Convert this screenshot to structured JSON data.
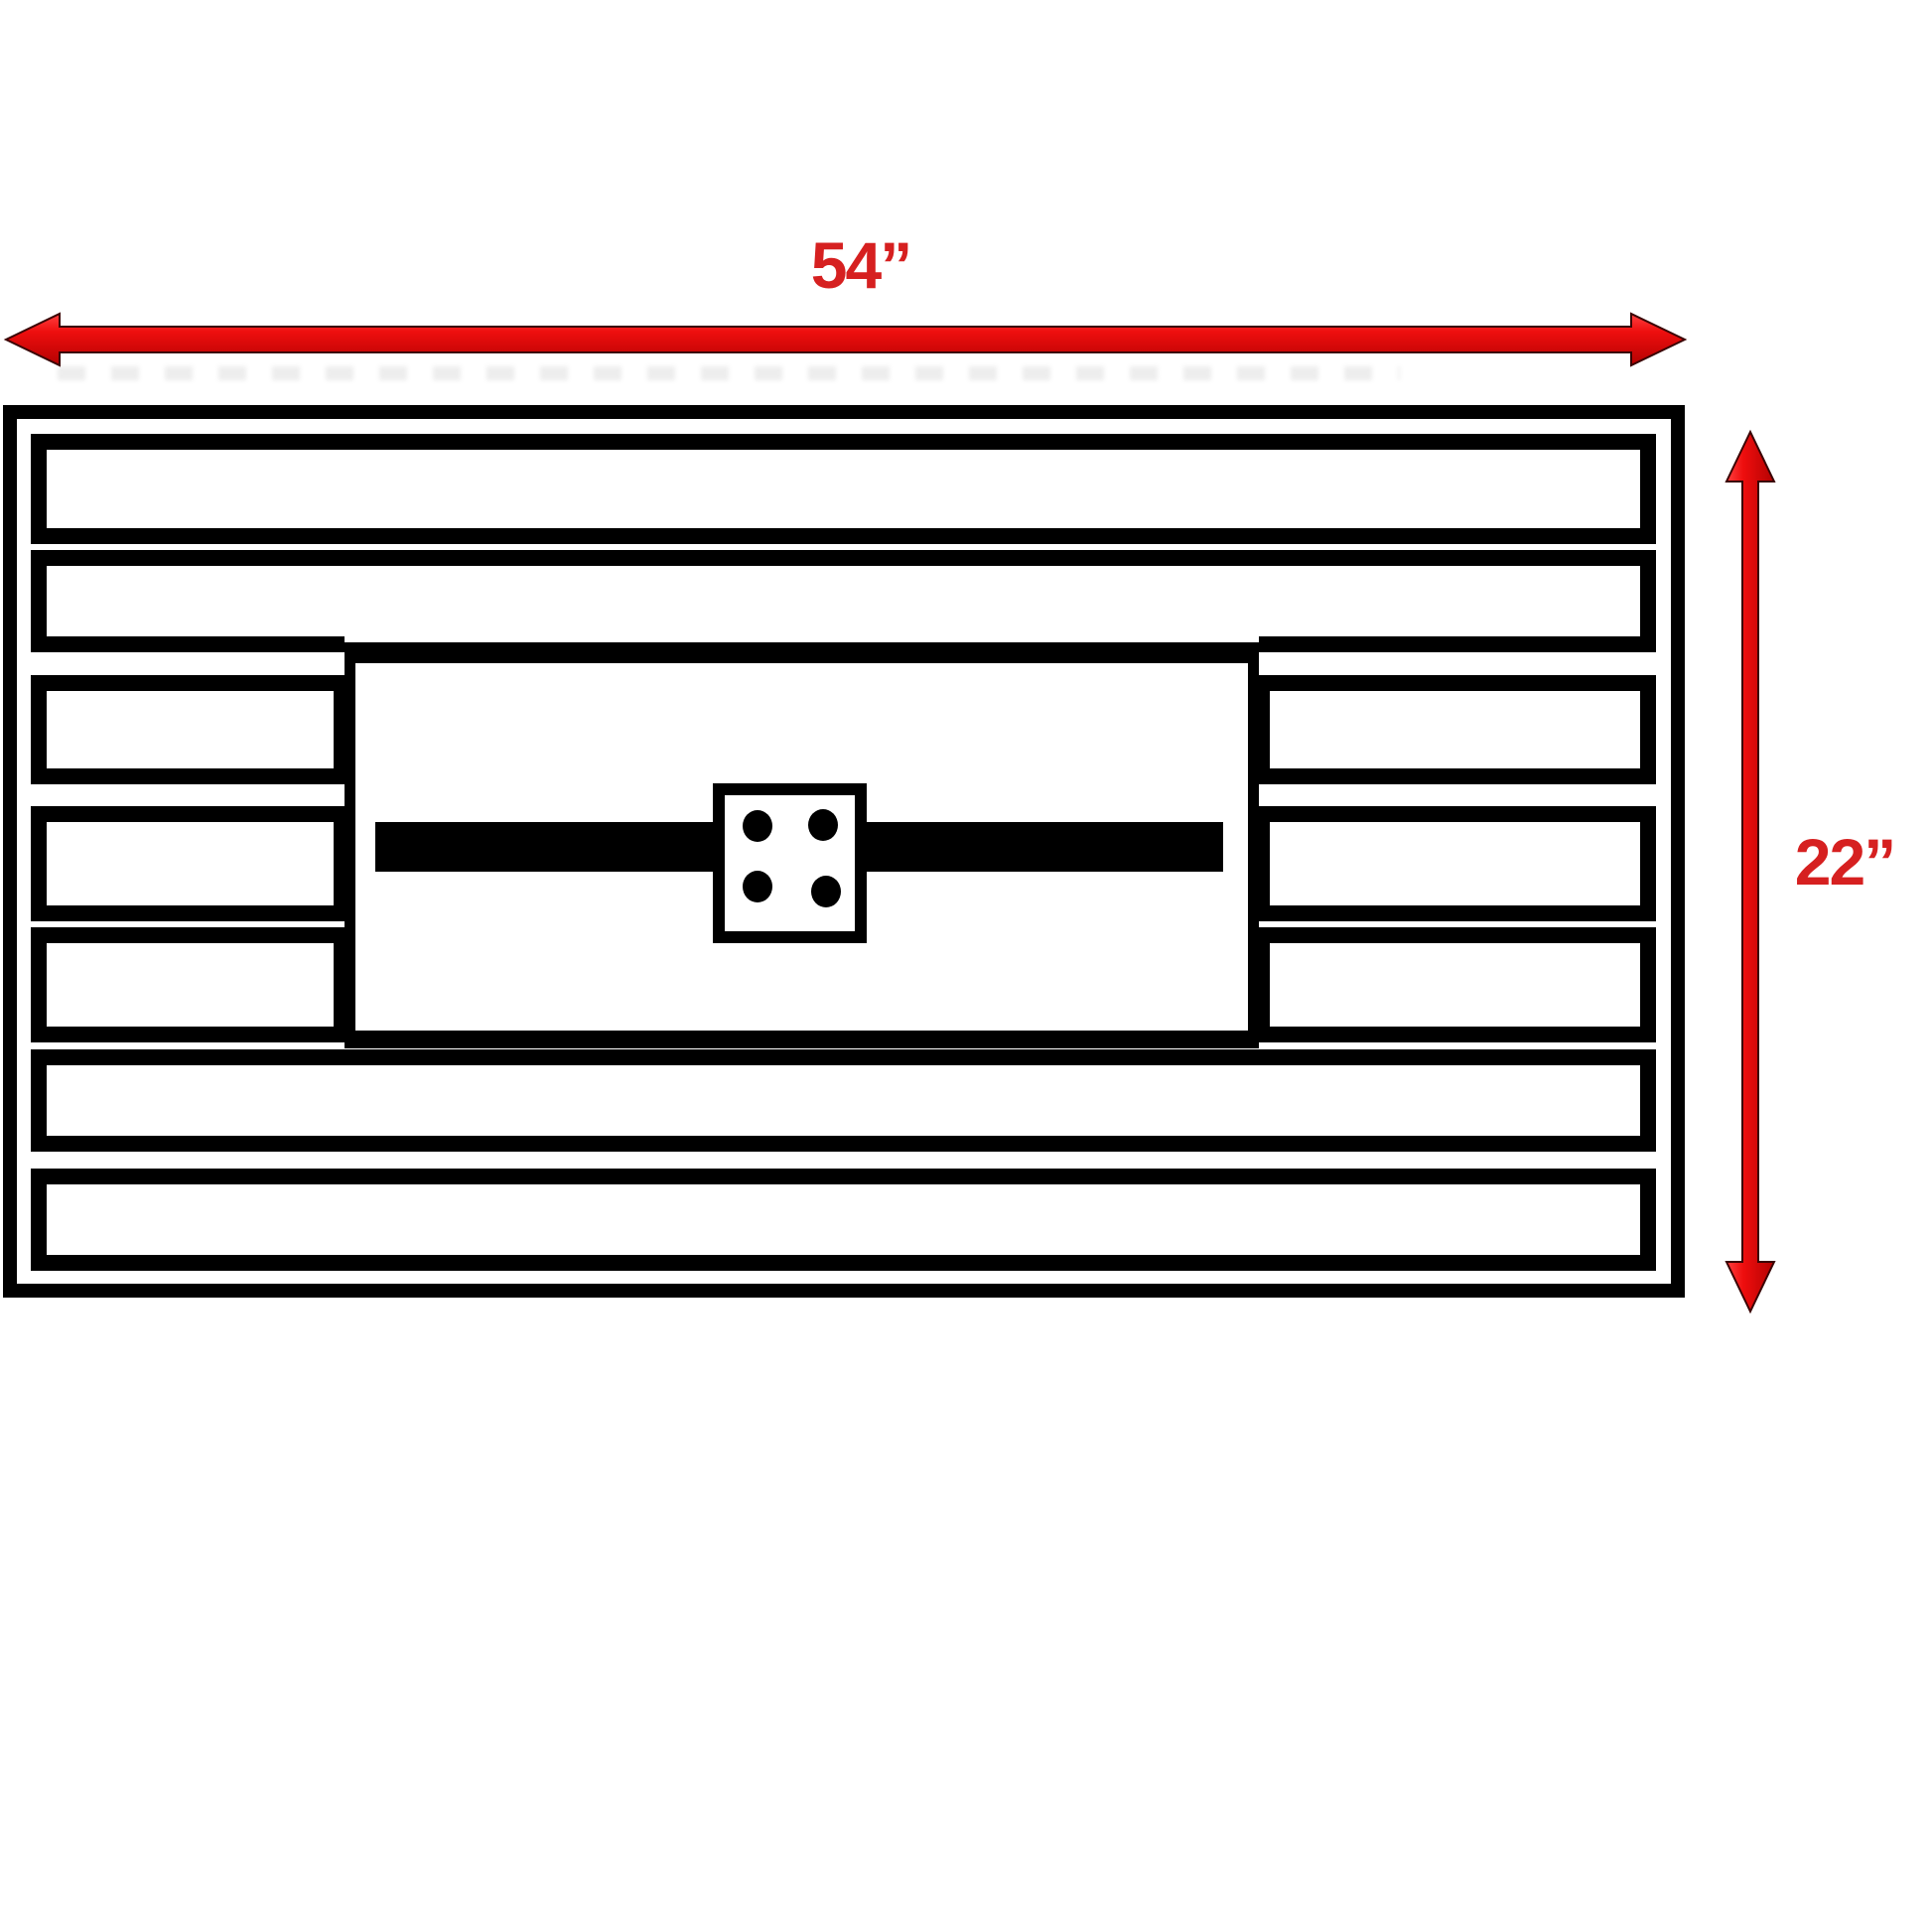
{
  "diagram": {
    "type": "dimension-drawing",
    "width_label": "54”",
    "height_label": "22”",
    "width_value_inches": 54,
    "height_value_inches": 22,
    "arrow_color": "#ed1111",
    "arrow_outline_color": "#3a0404",
    "label_color": "#d62020",
    "line_color": "#000000",
    "background_color": "#ffffff",
    "bolt_count": 4
  }
}
